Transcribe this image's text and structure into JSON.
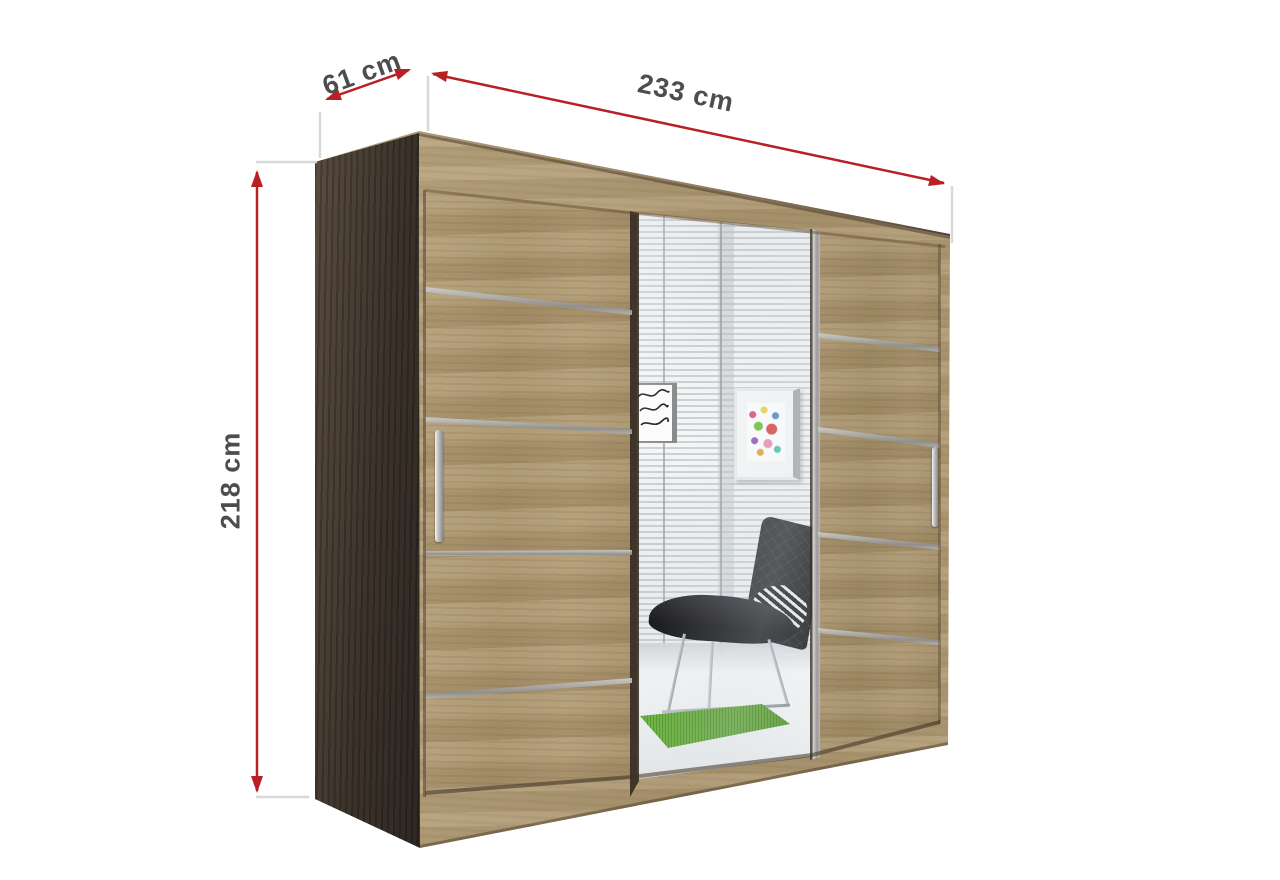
{
  "dimensions": {
    "width": {
      "label": "233 cm"
    },
    "depth": {
      "label": "61 cm"
    },
    "height": {
      "label": "218 cm"
    }
  },
  "colors": {
    "arrow_red": "#b92025",
    "label_gray": "#4d4d4d",
    "extension_line_gray": "#d8d8d8",
    "oak_light": "#b09a74",
    "oak_frame": "#b8a37e",
    "side_panel_dark_brown": "#3c332b",
    "aluminum_strip": "#b0b0b0",
    "door_gap_dark": "#2b241c",
    "mirror_wall_white": "#eff1f2",
    "rug_green": "#56a228",
    "chair_black": "#1d1d20",
    "background": "#ffffff"
  },
  "icons": {
    "width_arrow": "double-headed-arrow-icon",
    "depth_arrow": "double-headed-arrow-icon",
    "height_arrow": "double-headed-arrow-icon"
  }
}
